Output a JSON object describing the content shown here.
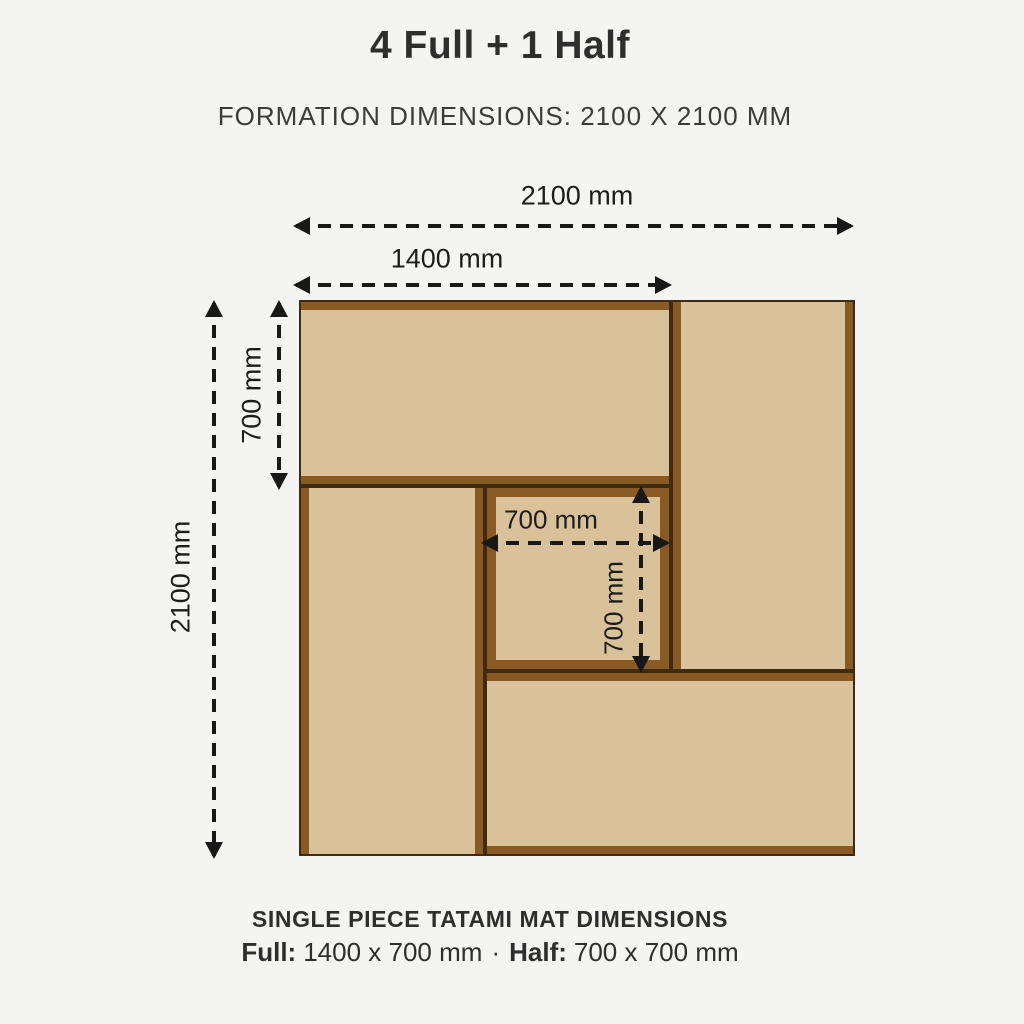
{
  "header": {
    "title": "4 Full + 1 Half",
    "subtitle": "FORMATION DIMENSIONS: 2100 X 2100 MM"
  },
  "dimensions": {
    "formation_width": "2100 mm",
    "full_mat_length": "1400 mm",
    "full_mat_width": "700 mm",
    "formation_height": "2100 mm",
    "half_mat_width": "700 mm",
    "half_mat_height": "700 mm"
  },
  "mats": [
    {
      "name": "full-mat-top-left",
      "type": "full",
      "orientation": "horizontal"
    },
    {
      "name": "full-mat-top-right",
      "type": "full",
      "orientation": "vertical"
    },
    {
      "name": "full-mat-bottom-left",
      "type": "full",
      "orientation": "vertical"
    },
    {
      "name": "half-mat-center",
      "type": "half",
      "orientation": "square"
    },
    {
      "name": "full-mat-bottom-right",
      "type": "full",
      "orientation": "horizontal"
    }
  ],
  "footer": {
    "heading": "SINGLE PIECE TATAMI MAT DIMENSIONS",
    "full_label": "Full:",
    "full_value": "1400 x 700 mm",
    "separator": "·",
    "half_label": "Half:",
    "half_value": "700 x 700 mm"
  },
  "colors": {
    "background": "#f4f4f2",
    "mat_fill": "#d9c199",
    "mat_band": "#8a5a25",
    "mat_outline": "#3e2b11",
    "dimension_line": "#181818",
    "text": "#2e2e2e"
  }
}
